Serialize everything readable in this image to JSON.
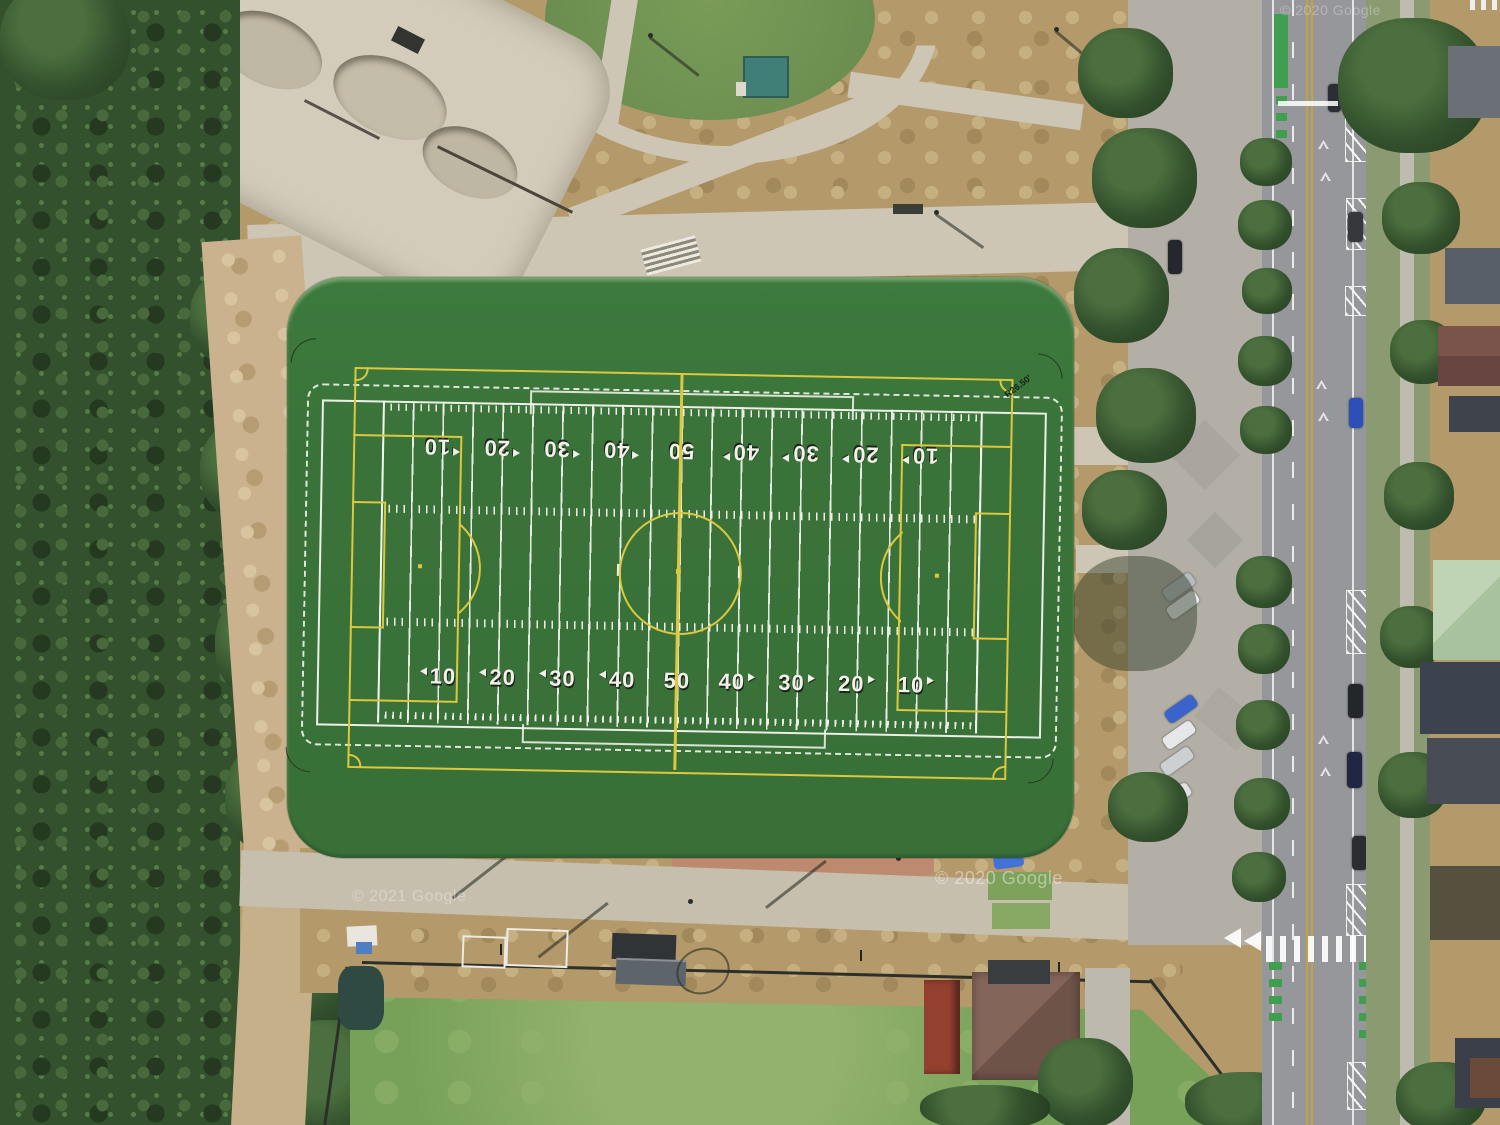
{
  "field": {
    "yard_numbers": [
      "10",
      "20",
      "30",
      "40",
      "50",
      "40",
      "30",
      "20",
      "10"
    ],
    "corner_radius_label": "R26.50'",
    "surface_color": "#3a7339",
    "football_line_color": "#f2f3ee",
    "soccer_line_color": "#dcc83e"
  },
  "watermarks": {
    "bottom_left": "© 2021 Google",
    "bottom_center": "© 2020 Google",
    "top_right": "© 2020 Google"
  },
  "palette": {
    "forest": "#33512d",
    "dry_grass": "#b49a6b",
    "concrete_path": "#cdc6b5",
    "street_asphalt": "#95979a",
    "street_centerline_yellow": "#c7a23b",
    "bike_lane_green": "#3f9e4f",
    "lower_pitch_green": "#77a159"
  }
}
